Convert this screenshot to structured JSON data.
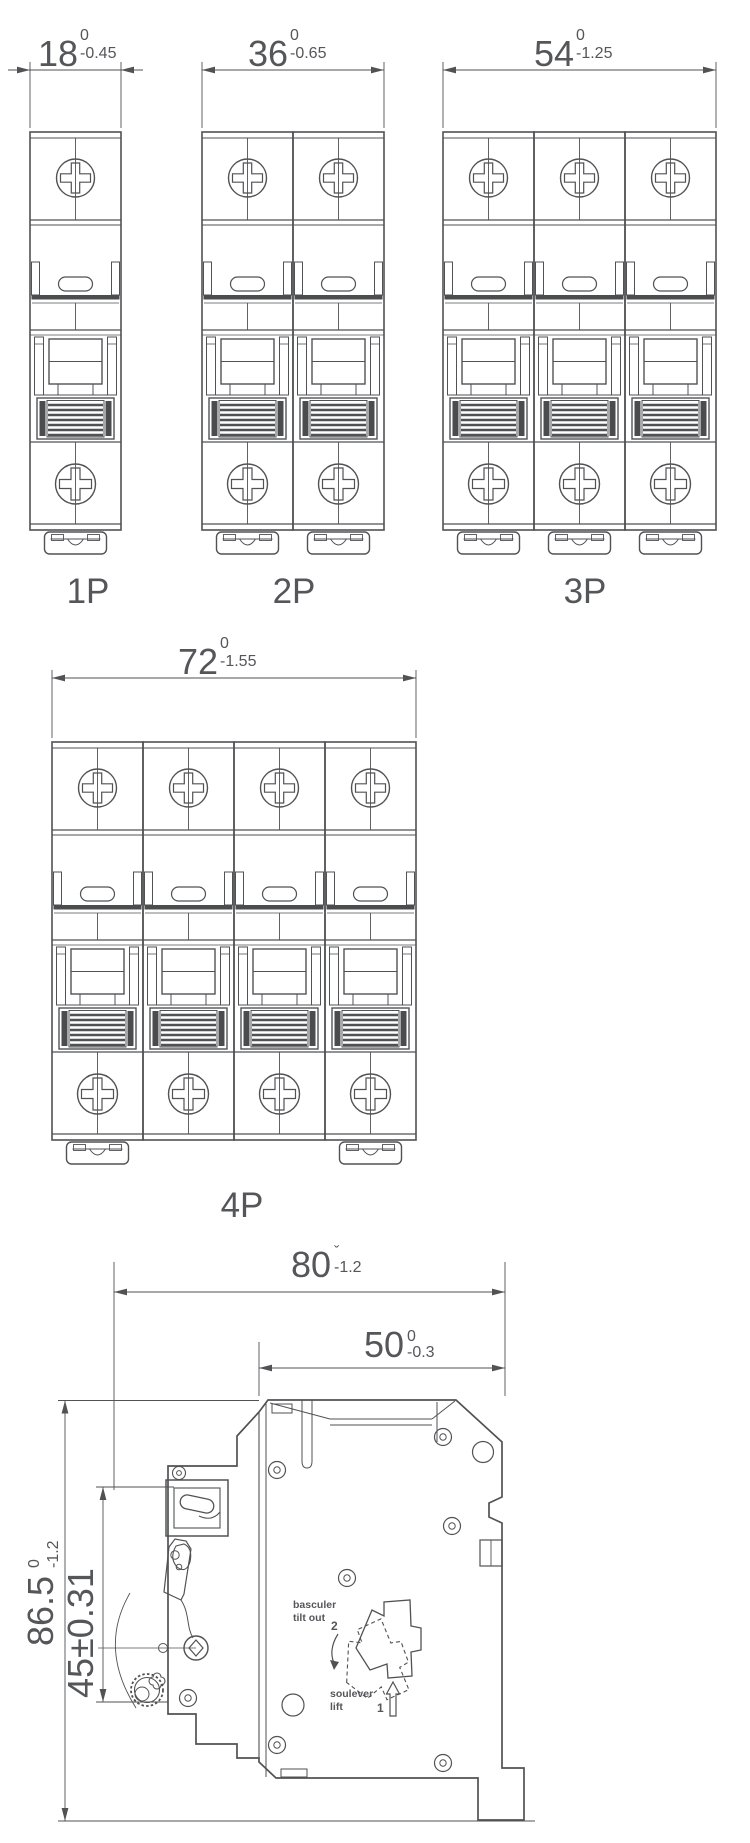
{
  "colors": {
    "line": "#515254",
    "text": "#55565a",
    "dark_fill": "#4b4c4e",
    "background": "#ffffff"
  },
  "front_views": [
    {
      "label": "1P",
      "poles": 1,
      "clip_modules": [
        0
      ],
      "dim": {
        "value": "18",
        "tol_top": "0",
        "tol_bottom": "-0.45"
      }
    },
    {
      "label": "2P",
      "poles": 2,
      "clip_modules": [
        0,
        1
      ],
      "dim": {
        "value": "36",
        "tol_top": "0",
        "tol_bottom": "-0.65"
      }
    },
    {
      "label": "3P",
      "poles": 3,
      "clip_modules": [
        0,
        1,
        2
      ],
      "dim": {
        "value": "54",
        "tol_top": "0",
        "tol_bottom": "-1.25"
      }
    },
    {
      "label": "4P",
      "poles": 4,
      "clip_modules": [
        0,
        3
      ],
      "dim": {
        "value": "72",
        "tol_top": "0",
        "tol_bottom": "-1.55"
      }
    }
  ],
  "side_view": {
    "dim_depth_total": {
      "value": "80",
      "tol_top": "ˇ",
      "tol_bottom": "-1.2"
    },
    "dim_depth_body": {
      "value": "50",
      "tol_top": "0",
      "tol_bottom": "-0.3"
    },
    "dim_height_total": {
      "value": "86.5",
      "tol_top": "0",
      "tol_bottom": "-1.2"
    },
    "dim_handle_height": {
      "value": "45±0.31"
    },
    "labels": {
      "tilt_fr": "basculer",
      "tilt_en": "tilt out",
      "tilt_step": "2",
      "lift_fr": "soulever",
      "lift_en": "lift",
      "lift_step": "1"
    }
  }
}
